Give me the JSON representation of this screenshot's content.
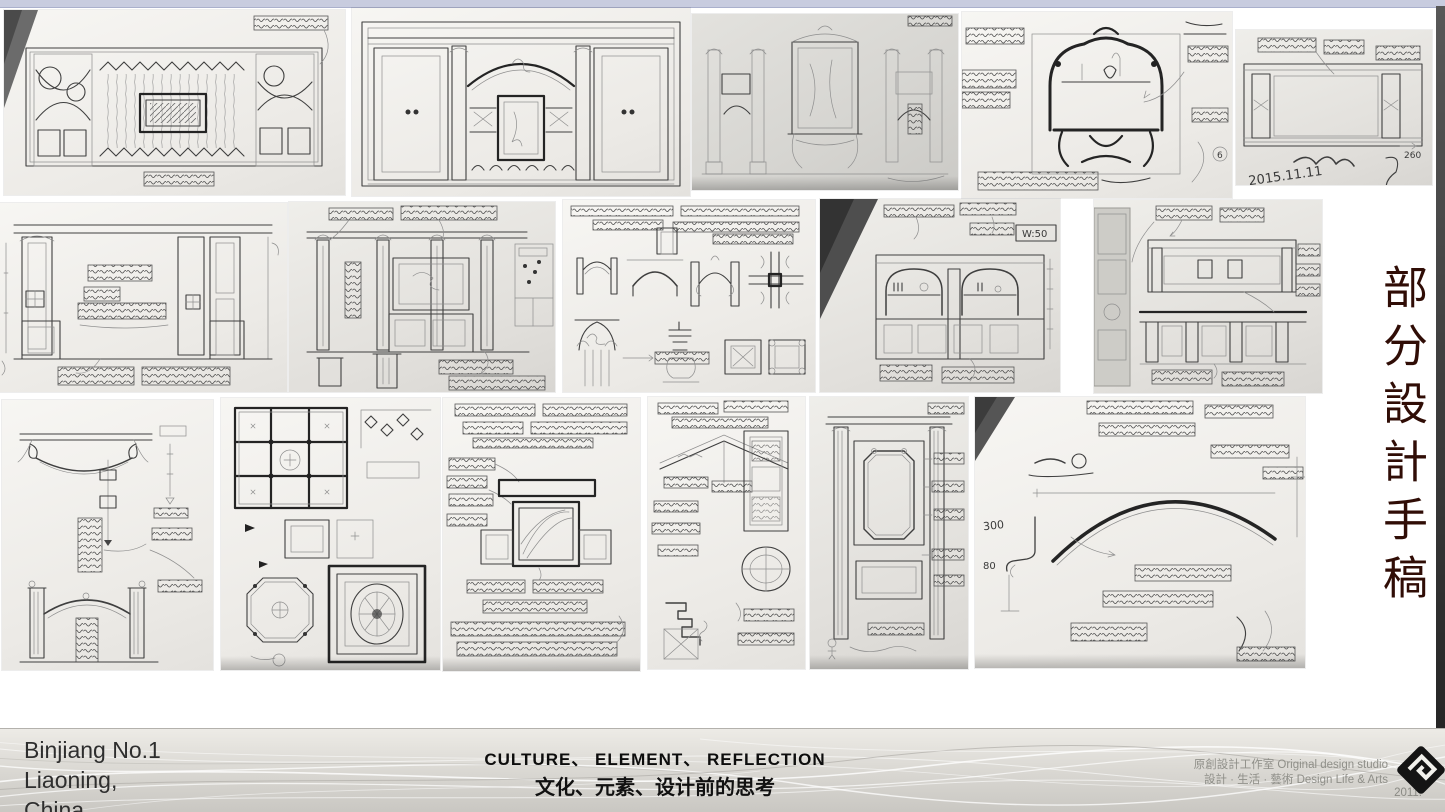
{
  "slide": {
    "vertical_title": "部分設計手稿",
    "colors": {
      "accent_title": "#300d06",
      "top_bar": "#c8ccdf",
      "footer_band": "#d8d6d1"
    }
  },
  "gallery": {
    "panels": {
      "r1p1": {
        "caption": "Hand sketch - TV feature wall elevation with lattice drapery field and patterned side bays"
      },
      "r1p2": {
        "caption": "Hand sketch - symmetrical cabinet wall with arched centre niche and columns"
      },
      "r1p3": {
        "caption": "Hand sketch - classical console wall with pedimented mirror and pilaster bays"
      },
      "r1p4": {
        "caption": "Hand sketch - ink study of console table with arched mirror frame",
        "annotations": {
          "num6": "6"
        }
      },
      "r1p5": {
        "caption": "Hand sketch - wide lattice grille transom panel",
        "annotations": {
          "date": "2015.11.11",
          "dim260": "260"
        }
      },
      "r2p1": {
        "caption": "Hand sketch - panelled wall elevation with written notes"
      },
      "r2p2": {
        "caption": "Hand sketch - pilastered wall elevation with plan snippet and pedestal details"
      },
      "r2p3": {
        "caption": "Hand sketch - arch, corner joint, Corinthian capital and moulding studies"
      },
      "r2p4": {
        "caption": "Hand sketch - double arched bookcase wall with lower cabinets",
        "annotations": {
          "w50": "W:50"
        }
      },
      "r2p5": {
        "caption": "Hand sketch - bar counter elevations with narrow floor plan strip"
      },
      "r3p1": {
        "caption": "Hand sketch - bracketed arch detail and arched doorway elevation"
      },
      "r3p2": {
        "caption": "Hand sketch - coffered ceiling grid, octagonal and oval medallion ceiling plans"
      },
      "r3p3": {
        "caption": "Hand sketch - feature wall elevation surrounded by note boxes"
      },
      "r3p4": {
        "caption": "Hand sketch - pediment section, oval medallion and moulding profile"
      },
      "r3p5": {
        "caption": "Hand sketch - tall framed wall panel with notched corner frame"
      },
      "r3p6": {
        "caption": "Hand sketch - large arch setting-out study with dimensions",
        "annotations": {
          "dim300": "300",
          "dim80": "80"
        }
      }
    }
  },
  "footer": {
    "project_line1": "Binjiang No.1",
    "project_line2": "Liaoning,",
    "project_line3": "China",
    "tagline_en": "CULTURE、 ELEMENT、 REFLECTION",
    "tagline_zh": "文化、元素、设计前的思考",
    "studio_line1": "原創設計工作室 Original design studio",
    "studio_line2": "設計 · 生活 · 藝術  Design Life & Arts",
    "year": "2011.",
    "logo": "original-design-studio-logo"
  }
}
